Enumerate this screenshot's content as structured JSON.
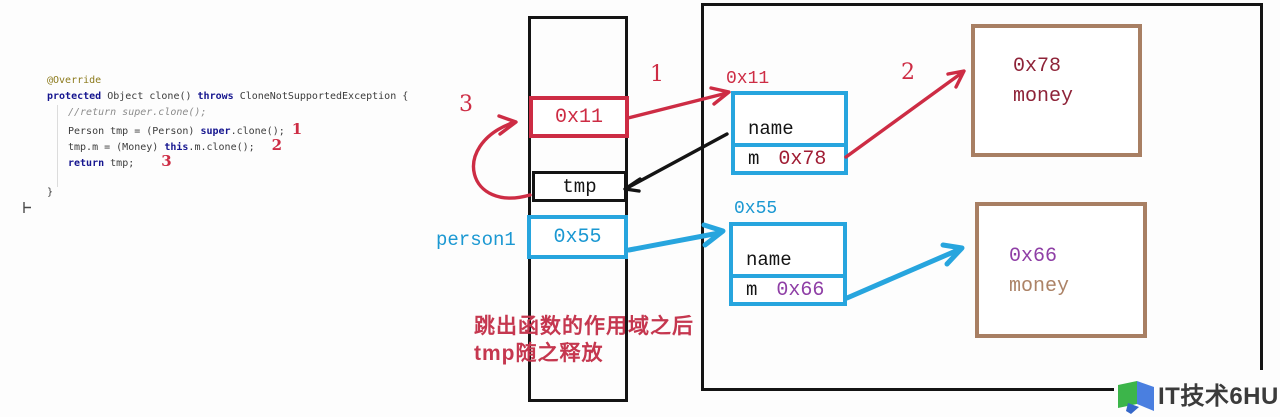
{
  "colors": {
    "red": "#CD2C44",
    "caption": "#C5374F",
    "cyan": "#27A5DE",
    "cyantext": "#1B98D2",
    "brown": "#A87F63",
    "maroon": "#8E2338",
    "purple": "#8F3FA6",
    "browntext": "#AC8367",
    "valred": "#A01C33",
    "ink": "#141414",
    "kw": "#15158F",
    "ann": "#8C7A1C",
    "cm": "#8C8C8C",
    "code": "#3C3C3C",
    "logotext": "#3B3B3B"
  },
  "code": {
    "lines": [
      {
        "indent": 0,
        "tokens": [
          {
            "t": "@Override",
            "c": "ann"
          }
        ]
      },
      {
        "indent": 0,
        "tokens": [
          {
            "t": "protected ",
            "c": "kw"
          },
          {
            "t": "Object clone() ",
            "c": "pl"
          },
          {
            "t": "throws ",
            "c": "kw"
          },
          {
            "t": "CloneNotSupportedException {",
            "c": "pl"
          }
        ]
      },
      {
        "indent": 1,
        "tokens": [
          {
            "t": "//return super.clone();",
            "c": "cm"
          }
        ]
      },
      {
        "indent": 1,
        "tokens": [
          {
            "t": "Person tmp = (Person) ",
            "c": "pl"
          },
          {
            "t": "super",
            "c": "kw"
          },
          {
            "t": ".clone();",
            "c": "pl"
          }
        ],
        "marker": "1"
      },
      {
        "indent": 1,
        "tokens": [
          {
            "t": "tmp.m = (Money) ",
            "c": "pl"
          },
          {
            "t": "this",
            "c": "kw"
          },
          {
            "t": ".m.clone();",
            "c": "pl"
          }
        ],
        "marker": "2"
      },
      {
        "indent": 1,
        "tokens": [
          {
            "t": "return ",
            "c": "kw"
          },
          {
            "t": "tmp;",
            "c": "pl"
          }
        ],
        "marker": "3"
      },
      {
        "indent": 0,
        "tokens": []
      },
      {
        "indent": 0,
        "tokens": [
          {
            "t": "}",
            "c": "pl"
          }
        ]
      }
    ]
  },
  "stack": {
    "tmp_value": "0x11",
    "tmp_label": "tmp",
    "person1_value": "0x55",
    "person1_label": "person1"
  },
  "heap": {
    "obj1": {
      "address": "0x11",
      "field1": "name",
      "field2": "m",
      "field2_value": "0x78"
    },
    "obj2": {
      "address": "0x55",
      "field1": "name",
      "field2": "m",
      "field2_value": "0x66"
    },
    "money1": {
      "address": "0x78",
      "label": "money"
    },
    "money2": {
      "address": "0x66",
      "label": "money"
    }
  },
  "annotations": {
    "step1": "1",
    "step2": "2",
    "step3": "3",
    "caption_line1": "跳出函数的作用域之后",
    "caption_line2": "tmp随之释放"
  },
  "watermark": {
    "text": "IT技术6HU"
  }
}
